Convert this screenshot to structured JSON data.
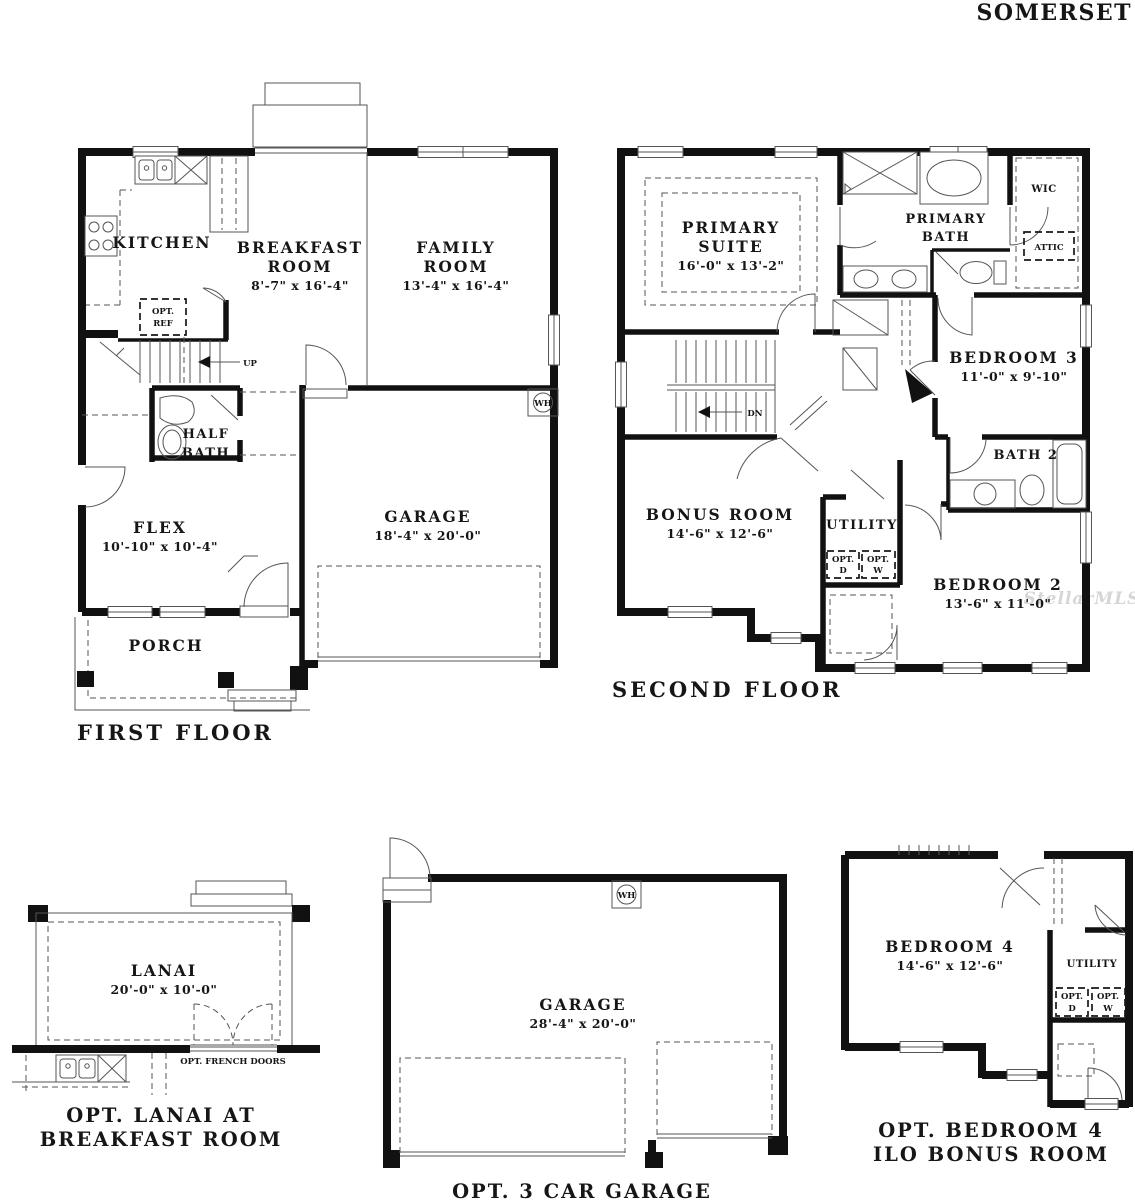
{
  "title": "SOMERSET",
  "watermark": "StellarMLS",
  "first_floor": {
    "caption": "FIRST FLOOR",
    "kitchen": "KITCHEN",
    "breakfast_lines": [
      "BREAKFAST",
      "ROOM"
    ],
    "breakfast_dims": "8'-7\" x 16'-4\"",
    "family_lines": [
      "FAMILY",
      "ROOM"
    ],
    "family_dims": "13'-4\" x 16'-4\"",
    "half_bath_lines": [
      "HALF",
      "BATH"
    ],
    "flex": "FLEX",
    "flex_dims": "10'-10\" x 10'-4\"",
    "garage": "GARAGE",
    "garage_dims": "18'-4\" x 20'-0\"",
    "porch": "PORCH",
    "opt_ref_lines": [
      "OPT.",
      "REF"
    ],
    "up": "UP",
    "wh": "WH"
  },
  "second_floor": {
    "caption": "SECOND FLOOR",
    "primary_suite_lines": [
      "PRIMARY",
      "SUITE"
    ],
    "primary_suite_dims": "16'-0\" x 13'-2\"",
    "primary_bath_lines": [
      "PRIMARY",
      "BATH"
    ],
    "wic": "WIC",
    "attic": "ATTIC",
    "bedroom3": "BEDROOM 3",
    "bedroom3_dims": "11'-0\" x 9'-10\"",
    "bath2": "BATH 2",
    "bonus_room": "BONUS ROOM",
    "bonus_room_dims": "14'-6\" x 12'-6\"",
    "utility": "UTILITY",
    "opt_d_lines": [
      "OPT.",
      "D"
    ],
    "opt_w_lines": [
      "OPT.",
      "W"
    ],
    "bedroom2": "BEDROOM 2",
    "bedroom2_dims": "13'-6\" x 11'-0\"",
    "dn": "DN"
  },
  "opt_lanai": {
    "caption_lines": [
      "OPT. LANAI AT",
      "BREAKFAST ROOM"
    ],
    "lanai": "LANAI",
    "lanai_dims": "20'-0\" x 10'-0\"",
    "french_doors": "OPT. FRENCH DOORS"
  },
  "opt_3car_garage": {
    "caption": "OPT. 3 CAR GARAGE",
    "garage": "GARAGE",
    "garage_dims": "28'-4\" x 20'-0\"",
    "wh": "WH"
  },
  "opt_bedroom4": {
    "caption_lines": [
      "OPT. BEDROOM 4",
      "ILO BONUS ROOM"
    ],
    "bedroom4": "BEDROOM 4",
    "bedroom4_dims": "14'-6\" x 12'-6\"",
    "utility": "UTILITY",
    "opt_d_lines": [
      "OPT.",
      "D"
    ],
    "opt_w_lines": [
      "OPT.",
      "W"
    ]
  }
}
